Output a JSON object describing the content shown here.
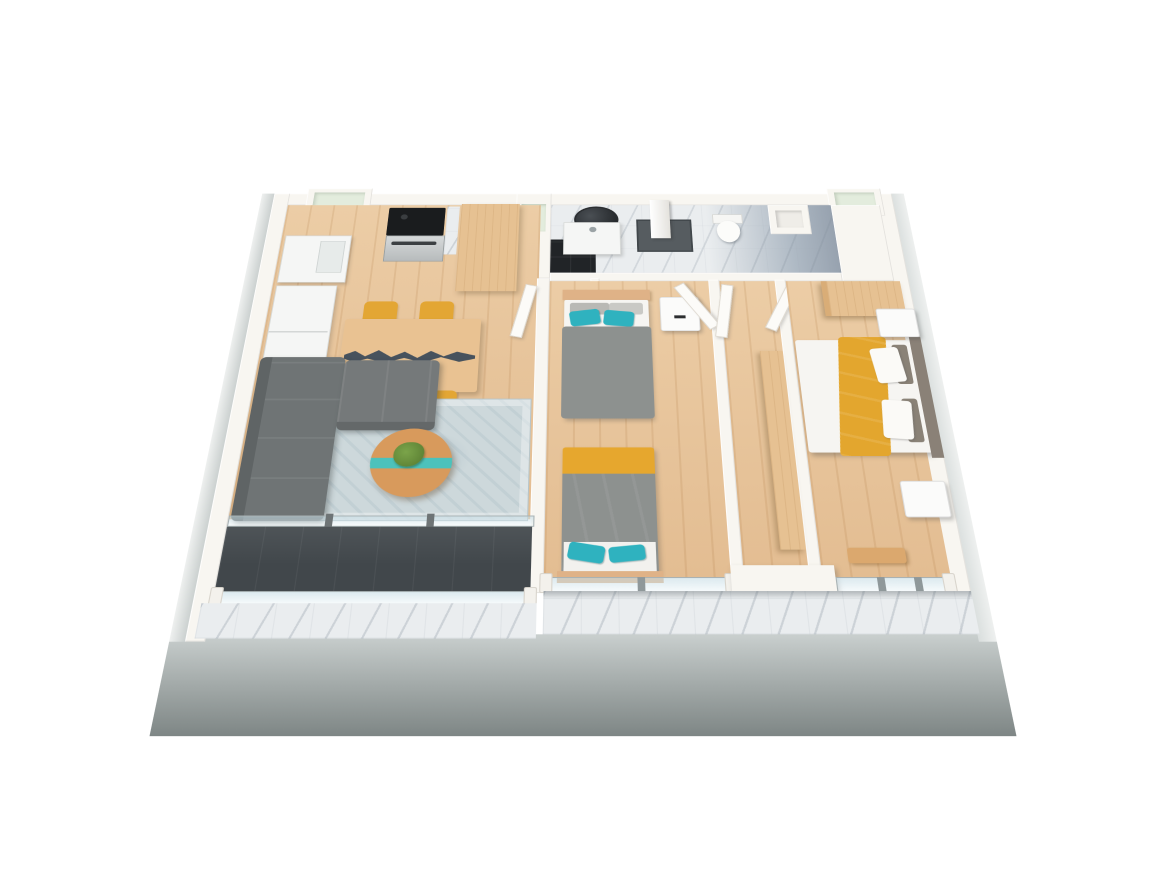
{
  "scene": {
    "type": "3d-floorplan-render",
    "view": "isometric-birdseye",
    "background_color": "#ffffff",
    "description": "Cut-away 3D render of a two-bedroom apartment floor plan viewed from above"
  },
  "rooms": [
    {
      "name": "kitchen-dining",
      "floor": "light-wood",
      "furniture": [
        "fridge",
        "sink-cabinet",
        "stove-oven",
        "marble-backsplash",
        "tall-cabinet",
        "dining-table-river-top",
        "four-yellow-chairs"
      ]
    },
    {
      "name": "living-area",
      "floor": "light-wood",
      "furniture": [
        "gray-corner-sofa",
        "blue-gray-rug",
        "round-river-coffee-table",
        "potted-plant"
      ]
    },
    {
      "name": "bathroom",
      "floor": "white-marble",
      "furniture": [
        "round-mirror",
        "sink-vanity",
        "shower-column",
        "shower-tray",
        "wall-hung-toilet",
        "duct-shaft",
        "black-tile-shower-floor"
      ]
    },
    {
      "name": "kids-bedroom",
      "floor": "light-wood",
      "furniture": [
        "single-bed-top",
        "single-bed-bottom",
        "white-nightstand",
        "teal-pillows",
        "yellow-blanket-stripes"
      ]
    },
    {
      "name": "hallway",
      "floor": "light-wood",
      "furniture": [
        "tall-wood-cabinet"
      ]
    },
    {
      "name": "master-bedroom",
      "floor": "light-wood",
      "furniture": [
        "double-bed-yellow-runner",
        "gray-headboard",
        "two-white-nightstands",
        "wood-wardrobe",
        "wood-bench"
      ]
    },
    {
      "name": "balcony",
      "floor": "dark-charcoal-tile",
      "furniture": [
        "glass-balustrade",
        "sliding-glass-door",
        "marble-ledge"
      ]
    }
  ],
  "palette": {
    "wood_floor": "#e9c79e",
    "wall_white": "#f8f6f1",
    "outer_wall_gray": "#8e9695",
    "marble_light": "#eaedef",
    "marble_dark": "#97a2af",
    "black_tile": "#212427",
    "balcony_floor": "#41474b",
    "sofa_gray": "#747879",
    "rug_blue_gray": "#cdd8db",
    "accent_yellow": "#e3a634",
    "accent_teal": "#2fb2bf",
    "table_river_slate": "#47525d",
    "coffee_river_teal": "#4cc2bb",
    "cabinet_tan": "#e6c192",
    "duvet_gray": "#8d918f",
    "bedding_white": "#f6f5f2",
    "glass": "#c4dbe4"
  },
  "openings": {
    "doors_open_white": 6,
    "windows_bottom_wall": 3,
    "niches_top_wall": [
      "green-niche-left",
      "green-niche-center",
      "green-niche-right"
    ]
  }
}
